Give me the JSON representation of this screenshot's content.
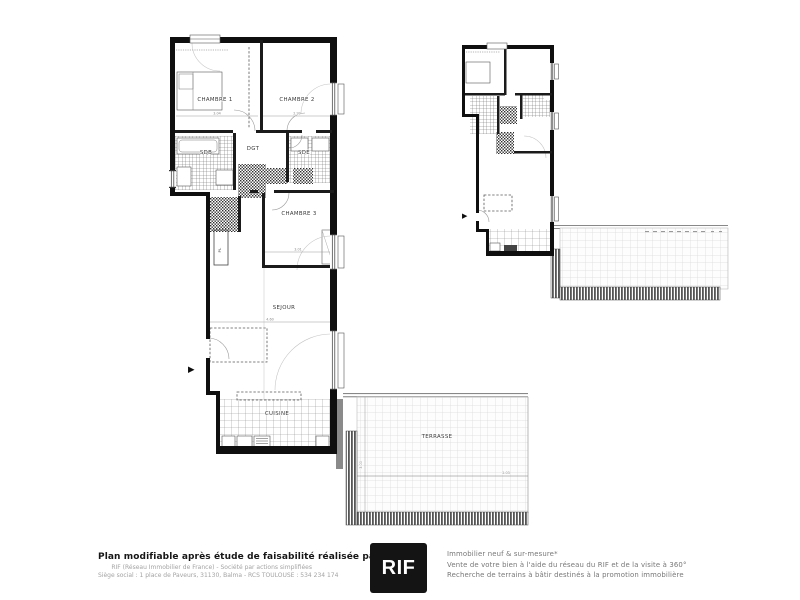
{
  "plan": {
    "rooms": {
      "chambre1": "CHAMBRE 1",
      "chambre2": "CHAMBRE 2",
      "chambre3": "CHAMBRE 3",
      "dgt": "DGT",
      "sdb": "SDB",
      "sde": "SDE",
      "pl": "PL",
      "sejour": "SEJOUR",
      "cuisine": "CUISINE",
      "terrasse": "TERRASSE"
    },
    "dims": {
      "ch1": "3.04",
      "ch2": "2.99",
      "ch3": "3.01",
      "sejour": "4.60",
      "ter_w": "2.03",
      "ter_h": "3.00"
    }
  },
  "icons": {
    "entry_arrow": "▶"
  },
  "colors": {
    "wall": "#0f0f0f",
    "hatch_dark": "#555555",
    "grid_light": "#cccccc",
    "logo_bg": "#141414",
    "text_gray": "#777777"
  },
  "footer": {
    "title": "Plan modifiable après étude de faisabilité réalisée par le RIF",
    "subtitle1": "RIF (Réseau Immobilier de France) - Société par actions simplifiées",
    "subtitle2": "Siège social : 1 place de Paveurs, 31130, Balma - RCS TOULOUSE : 534 234 174",
    "logo_text": "RIF",
    "services": [
      "Immobilier neuf & sur-mesure*",
      "Vente de votre bien à l'aide du réseau du RIF et de la visite à 360°",
      "Recherche de terrains à bâtir destinés à la promotion immobilière"
    ]
  }
}
